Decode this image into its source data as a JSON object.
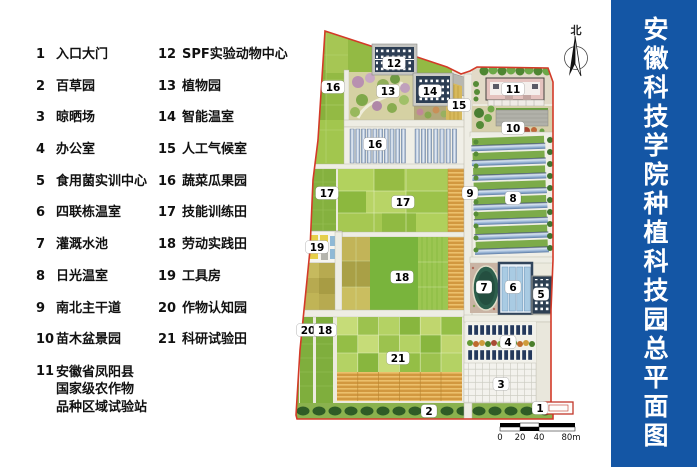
{
  "title": {
    "text": "安徽科技学院种植科技园总平面图",
    "bar_color": "#1456a5"
  },
  "legend": {
    "columns": [
      {
        "items": [
          {
            "num": "1",
            "lines": [
              "入口大门"
            ]
          },
          {
            "num": "2",
            "lines": [
              "百草园"
            ]
          },
          {
            "num": "3",
            "lines": [
              "晾晒场"
            ]
          },
          {
            "num": "4",
            "lines": [
              "办公室"
            ]
          },
          {
            "num": "5",
            "lines": [
              "食用菌实训中心"
            ]
          },
          {
            "num": "6",
            "lines": [
              "四联栋温室"
            ]
          },
          {
            "num": "7",
            "lines": [
              "灌溉水池"
            ]
          },
          {
            "num": "8",
            "lines": [
              "日光温室"
            ]
          },
          {
            "num": "9",
            "lines": [
              "南北主干道"
            ]
          },
          {
            "num": "10",
            "lines": [
              "苗木盆景园"
            ]
          },
          {
            "num": "11",
            "lines": [
              "安徽省凤阳县",
              "国家级农作物",
              "品种区域试验站"
            ]
          }
        ]
      },
      {
        "items": [
          {
            "num": "12",
            "lines": [
              "SPF实验动物中心"
            ]
          },
          {
            "num": "13",
            "lines": [
              "植物园"
            ]
          },
          {
            "num": "14",
            "lines": [
              "智能温室"
            ]
          },
          {
            "num": "15",
            "lines": [
              "人工气候室"
            ]
          },
          {
            "num": "16",
            "lines": [
              "蔬菜瓜果园"
            ]
          },
          {
            "num": "17",
            "lines": [
              "技能训练田"
            ]
          },
          {
            "num": "18",
            "lines": [
              "劳动实践田"
            ]
          },
          {
            "num": "19",
            "lines": [
              "工具房"
            ]
          },
          {
            "num": "20",
            "lines": [
              "作物认知园"
            ]
          },
          {
            "num": "21",
            "lines": [
              "科研试验田"
            ]
          }
        ]
      }
    ]
  },
  "map": {
    "north_label": "北",
    "boundary_color": "#d33a28",
    "labels": [
      {
        "t": "16",
        "x": 333,
        "y": 87
      },
      {
        "t": "12",
        "x": 394,
        "y": 63
      },
      {
        "t": "13",
        "x": 388,
        "y": 91
      },
      {
        "t": "14",
        "x": 430,
        "y": 91
      },
      {
        "t": "15",
        "x": 459,
        "y": 105
      },
      {
        "t": "11",
        "x": 513,
        "y": 89
      },
      {
        "t": "10",
        "x": 513,
        "y": 128
      },
      {
        "t": "16",
        "x": 375,
        "y": 144
      },
      {
        "t": "17",
        "x": 327,
        "y": 193
      },
      {
        "t": "9",
        "x": 470,
        "y": 193
      },
      {
        "t": "8",
        "x": 513,
        "y": 198
      },
      {
        "t": "17",
        "x": 403,
        "y": 202
      },
      {
        "t": "19",
        "x": 317,
        "y": 247
      },
      {
        "t": "18",
        "x": 402,
        "y": 277
      },
      {
        "t": "7",
        "x": 484,
        "y": 287
      },
      {
        "t": "6",
        "x": 513,
        "y": 287
      },
      {
        "t": "5",
        "x": 541,
        "y": 294
      },
      {
        "t": "20",
        "x": 308,
        "y": 330
      },
      {
        "t": "18",
        "x": 325,
        "y": 330
      },
      {
        "t": "4",
        "x": 508,
        "y": 342
      },
      {
        "t": "21",
        "x": 398,
        "y": 358
      },
      {
        "t": "3",
        "x": 501,
        "y": 384
      },
      {
        "t": "2",
        "x": 429,
        "y": 411
      },
      {
        "t": "1",
        "x": 540,
        "y": 408
      }
    ],
    "scale": {
      "ticks": [
        {
          "t": "0",
          "x": 500
        },
        {
          "t": "20",
          "x": 520
        },
        {
          "t": "40",
          "x": 539
        },
        {
          "t": "80m",
          "x": 571
        }
      ]
    }
  }
}
